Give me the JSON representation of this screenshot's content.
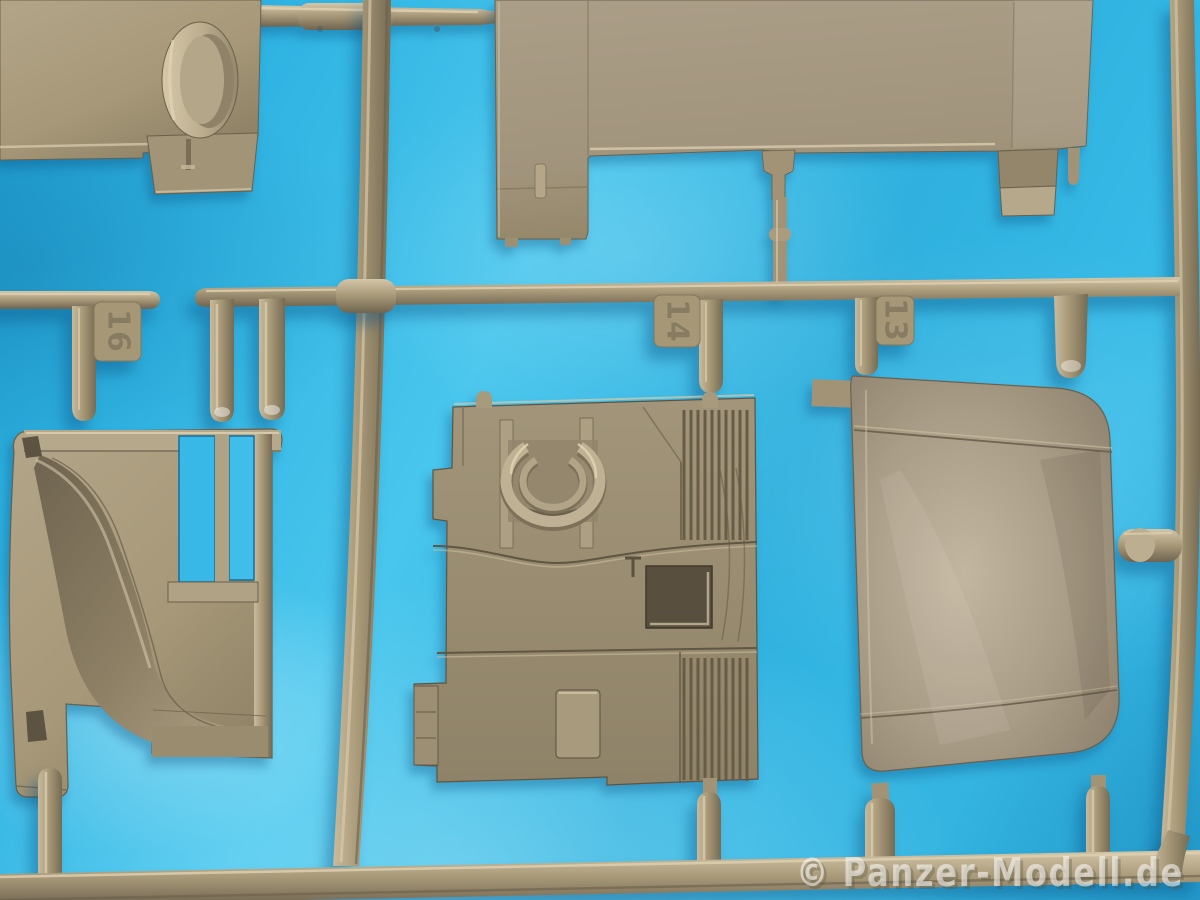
{
  "watermark": {
    "text": "© Panzer-Modell.de"
  },
  "sprue_gate_labels": {
    "left": "16",
    "center": "14",
    "right": "13"
  },
  "palette": {
    "background_cyan": "#2fb6e5",
    "plastic_base": "#a39376",
    "plastic_highlight": "#d8cbad",
    "plastic_shadow": "#6b604b"
  }
}
